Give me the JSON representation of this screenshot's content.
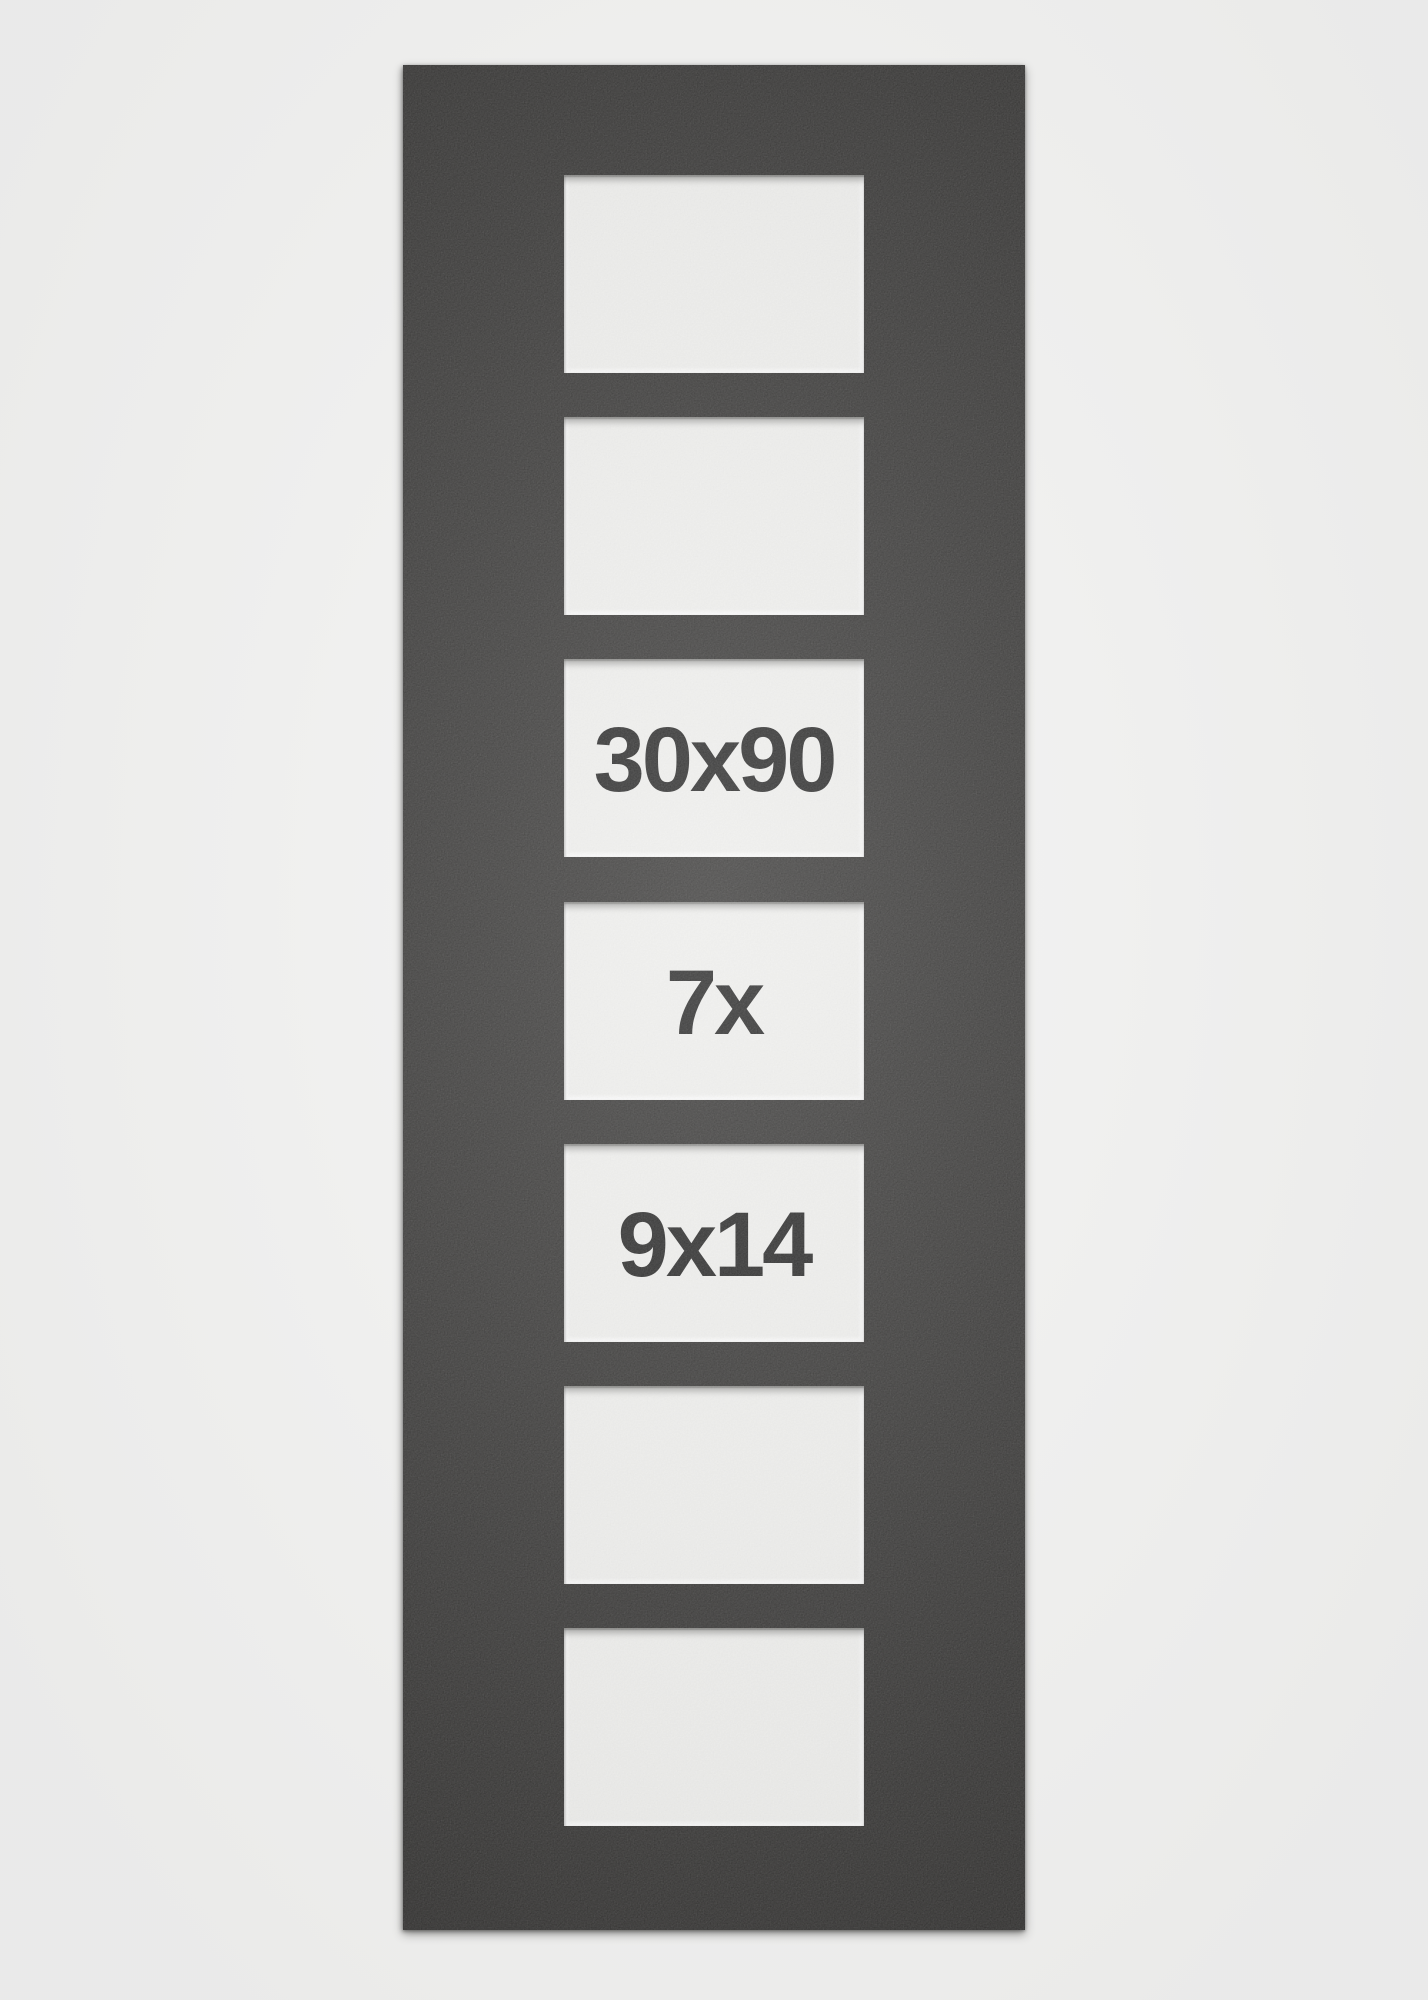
{
  "page": {
    "background_color": "#f2f2f1"
  },
  "mat": {
    "description": "black multi-aperture passepartout product photo",
    "mat_color_hex": "#222120",
    "opening_color_hex": "#f3f3f1",
    "label_color_hex": "#101010",
    "size_label": "30x90",
    "count_label": "7x",
    "opening_size_label": "9x14"
  },
  "apertures": [
    {
      "label": ""
    },
    {
      "label": ""
    },
    {
      "label": "30x90"
    },
    {
      "label": "7x"
    },
    {
      "label": "9x14"
    },
    {
      "label": ""
    },
    {
      "label": ""
    }
  ]
}
